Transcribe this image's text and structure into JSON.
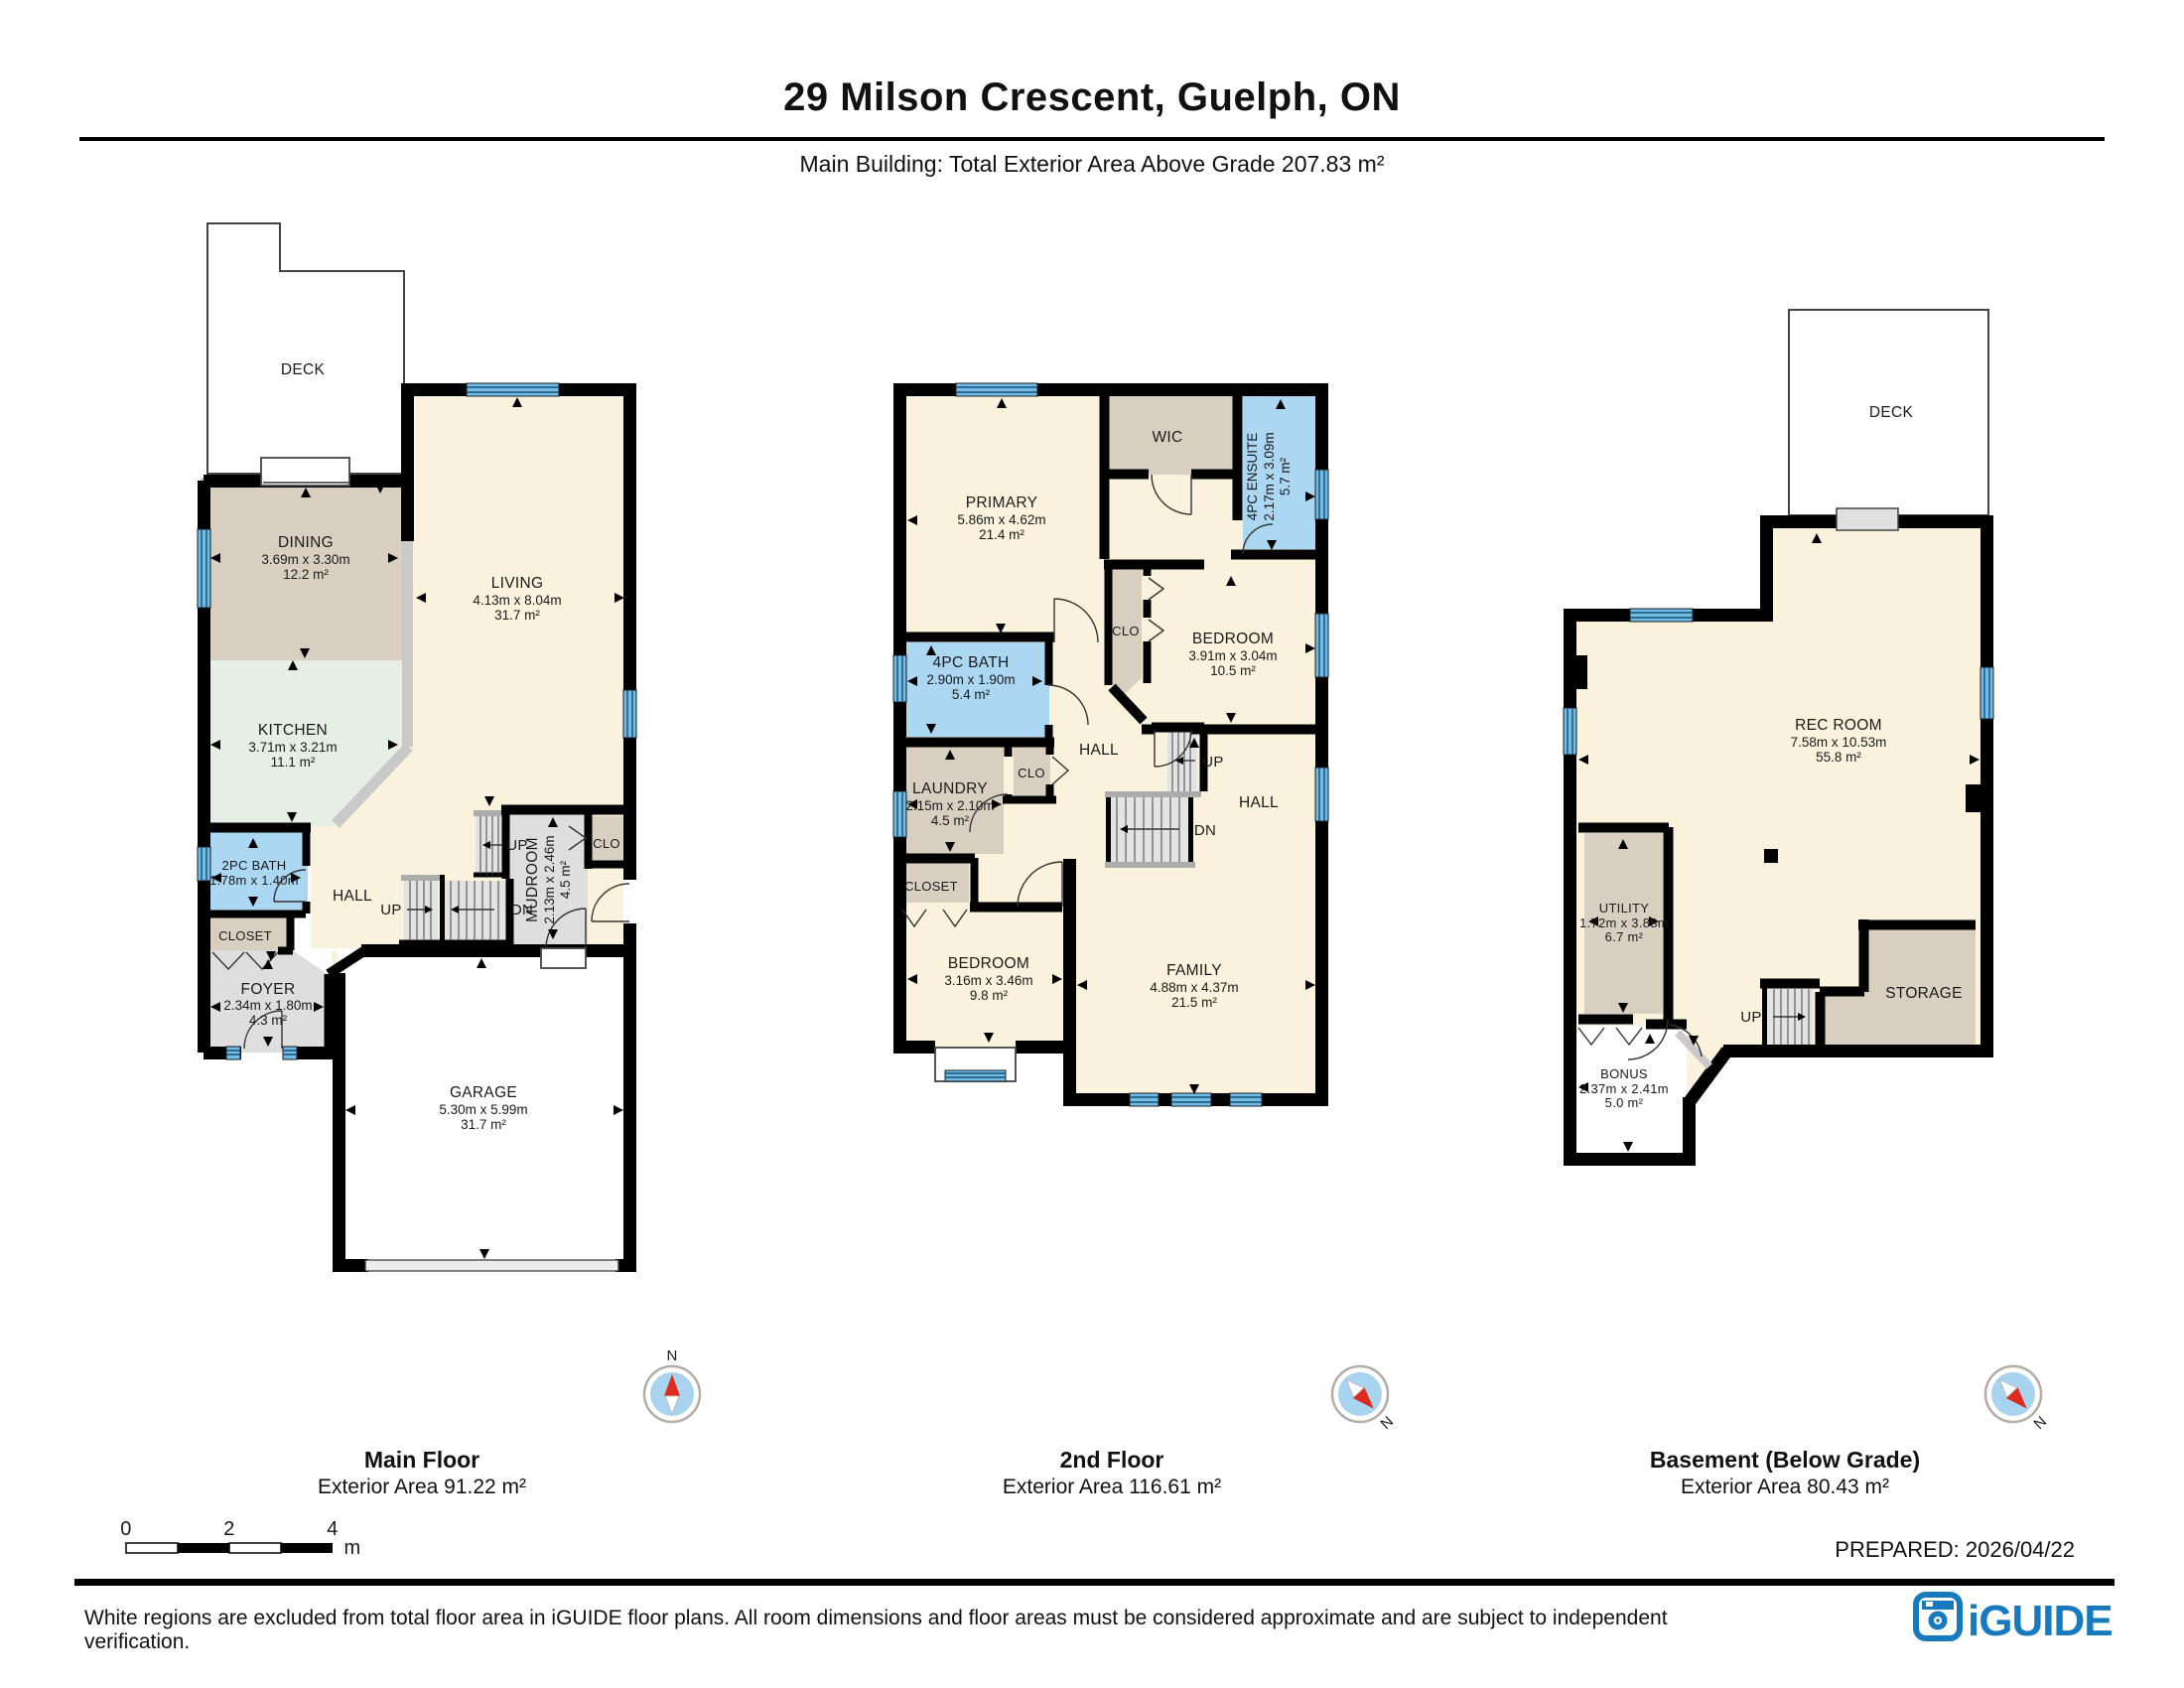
{
  "header": {
    "title": "29 Milson Crescent, Guelph, ON",
    "subtitle": "Main Building: Total Exterior Area Above Grade 207.83 m²"
  },
  "floors": [
    {
      "caption": "Main Floor",
      "area_caption": "Exterior Area 91.22 m²",
      "labels": {
        "deck": "DECK",
        "dining": [
          "DINING",
          "3.69m x 3.30m",
          "12.2 m²"
        ],
        "living": [
          "LIVING",
          "4.13m x 8.04m",
          "31.7 m²"
        ],
        "kitchen": [
          "KITCHEN",
          "3.71m x 3.21m",
          "11.1 m²"
        ],
        "bath": [
          "2PC BATH",
          "1.78m x 1.40m"
        ],
        "closet": "CLOSET",
        "hall": "HALL",
        "foyer": [
          "FOYER",
          "2.34m x 1.80m",
          "4.3 m²"
        ],
        "mudroom": [
          "MUDROOM",
          "2.13m x 2.46m",
          "4.5 m²"
        ],
        "clo": "CLO",
        "garage": [
          "GARAGE",
          "5.30m x 5.99m",
          "31.7 m²"
        ],
        "up1": "UP",
        "up2": "UP",
        "dn": "DN"
      }
    },
    {
      "caption": "2nd Floor",
      "area_caption": "Exterior Area 116.61 m²",
      "labels": {
        "primary": [
          "PRIMARY",
          "5.86m x 4.62m",
          "21.4 m²"
        ],
        "wic": "WIC",
        "ensuite": [
          "4PC ENSUITE",
          "2.17m x 3.09m",
          "5.7 m²"
        ],
        "bedroom2": [
          "BEDROOM",
          "3.91m x 3.04m",
          "10.5 m²"
        ],
        "clo1": "CLO",
        "bath": [
          "4PC BATH",
          "2.90m x 1.90m",
          "5.4 m²"
        ],
        "laundry": [
          "LAUNDRY",
          "2.15m x 2.10m",
          "4.5 m²"
        ],
        "clo2": "CLO",
        "closet": "CLOSET",
        "bedroom3": [
          "BEDROOM",
          "3.16m x 3.46m",
          "9.8 m²"
        ],
        "family": [
          "FAMILY",
          "4.88m x 4.37m",
          "21.5 m²"
        ],
        "hall1": "HALL",
        "hall2": "HALL",
        "up": "UP",
        "dn": "DN"
      }
    },
    {
      "caption": "Basement (Below Grade)",
      "area_caption": "Exterior Area 80.43 m²",
      "labels": {
        "deck": "DECK",
        "rec": [
          "REC ROOM",
          "7.58m x 10.53m",
          "55.8 m²"
        ],
        "utility": [
          "UTILITY",
          "1.72m x 3.88m",
          "6.7 m²"
        ],
        "storage": "STORAGE",
        "bonus": [
          "BONUS",
          "2.37m x 2.41m",
          "5.0 m²"
        ],
        "up": "UP"
      }
    }
  ],
  "compass_label": "N",
  "scale_bar": {
    "ticks": [
      "0",
      "2",
      "4"
    ],
    "unit": "m"
  },
  "prepared": "PREPARED: 2026/04/22",
  "footer": {
    "disclaimer": "White regions are excluded from total floor area in iGUIDE floor plans. All room dimensions and floor areas must be considered approximate and are subject to independent verification.",
    "brand": "iGUIDE"
  },
  "colors": {
    "wall": "#000000",
    "floor_cream": "#FAF2DC",
    "closet_tan": "#D9CFC1",
    "kitchen_green": "#E6EEE6",
    "bath_blue": "#ABD7F2",
    "window_blue": "#6FBCE8",
    "room_gray": "#DEDEDE",
    "stair_gray": "#E3E3E3",
    "brand_blue": "#1779BE",
    "compass_red": "#DD2B20",
    "compass_blue": "#A8D4F0"
  }
}
